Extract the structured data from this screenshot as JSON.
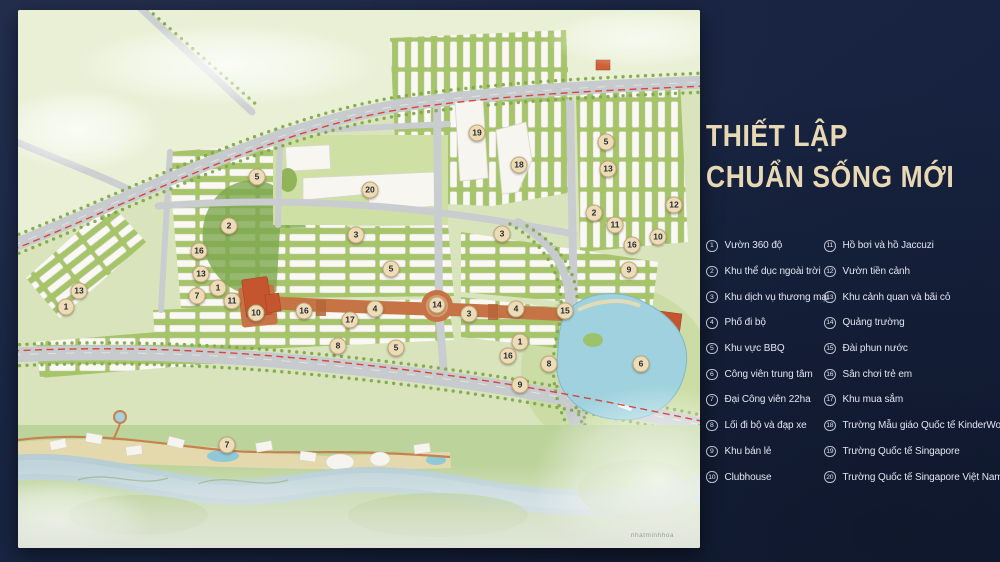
{
  "panel": {
    "title_line1": "THIẾT LẬP",
    "title_line2": "CHUẨN SỐNG MỚI"
  },
  "legend": {
    "items": [
      {
        "num": "1",
        "label": "Vườn 360 độ"
      },
      {
        "num": "2",
        "label": "Khu thể dục ngoài trời"
      },
      {
        "num": "3",
        "label": "Khu dịch vụ thương mại"
      },
      {
        "num": "4",
        "label": "Phố đi bộ"
      },
      {
        "num": "5",
        "label": "Khu vực BBQ"
      },
      {
        "num": "6",
        "label": "Công viên trung tâm"
      },
      {
        "num": "7",
        "label": "Đại Công viên 22ha"
      },
      {
        "num": "8",
        "label": "Lối đi bộ và đạp xe"
      },
      {
        "num": "9",
        "label": "Khu bán lẻ"
      },
      {
        "num": "10",
        "label": "Clubhouse"
      },
      {
        "num": "11",
        "label": "Hồ bơi và hồ Jaccuzi"
      },
      {
        "num": "12",
        "label": "Vườn tiền cảnh"
      },
      {
        "num": "13",
        "label": "Khu cảnh quan và bãi cỏ"
      },
      {
        "num": "14",
        "label": "Quảng trường"
      },
      {
        "num": "15",
        "label": "Đài phun nước"
      },
      {
        "num": "16",
        "label": "Sân chơi trẻ em"
      },
      {
        "num": "17",
        "label": "Khu mua sắm"
      },
      {
        "num": "18",
        "label": "Trường Mẫu giáo Quốc tế KinderWorld"
      },
      {
        "num": "19",
        "label": "Trường Quốc tế Singapore"
      },
      {
        "num": "20",
        "label": "Trường Quốc tế Singapore Việt Nam"
      }
    ]
  },
  "map": {
    "watermark": "nhatminhhoa",
    "markers": [
      {
        "n": "13",
        "x": 61,
        "y": 281
      },
      {
        "n": "1",
        "x": 48,
        "y": 297
      },
      {
        "n": "5",
        "x": 239,
        "y": 167
      },
      {
        "n": "2",
        "x": 211,
        "y": 216
      },
      {
        "n": "16",
        "x": 181,
        "y": 241
      },
      {
        "n": "13",
        "x": 183,
        "y": 264
      },
      {
        "n": "1",
        "x": 200,
        "y": 278
      },
      {
        "n": "7",
        "x": 179,
        "y": 286
      },
      {
        "n": "11",
        "x": 214,
        "y": 291
      },
      {
        "n": "10",
        "x": 238,
        "y": 303
      },
      {
        "n": "20",
        "x": 352,
        "y": 180
      },
      {
        "n": "19",
        "x": 459,
        "y": 123
      },
      {
        "n": "18",
        "x": 501,
        "y": 155
      },
      {
        "n": "3",
        "x": 338,
        "y": 225
      },
      {
        "n": "3",
        "x": 484,
        "y": 224
      },
      {
        "n": "5",
        "x": 373,
        "y": 259
      },
      {
        "n": "16",
        "x": 286,
        "y": 301
      },
      {
        "n": "17",
        "x": 332,
        "y": 310
      },
      {
        "n": "4",
        "x": 357,
        "y": 299
      },
      {
        "n": "8",
        "x": 320,
        "y": 336
      },
      {
        "n": "5",
        "x": 378,
        "y": 338
      },
      {
        "n": "14",
        "x": 419,
        "y": 295
      },
      {
        "n": "5",
        "x": 588,
        "y": 132
      },
      {
        "n": "13",
        "x": 590,
        "y": 159
      },
      {
        "n": "2",
        "x": 576,
        "y": 203
      },
      {
        "n": "11",
        "x": 597,
        "y": 215
      },
      {
        "n": "12",
        "x": 656,
        "y": 195
      },
      {
        "n": "10",
        "x": 640,
        "y": 227
      },
      {
        "n": "16",
        "x": 614,
        "y": 235
      },
      {
        "n": "9",
        "x": 611,
        "y": 260
      },
      {
        "n": "3",
        "x": 451,
        "y": 304
      },
      {
        "n": "4",
        "x": 498,
        "y": 299
      },
      {
        "n": "15",
        "x": 547,
        "y": 301
      },
      {
        "n": "1",
        "x": 502,
        "y": 332
      },
      {
        "n": "16",
        "x": 490,
        "y": 346
      },
      {
        "n": "8",
        "x": 531,
        "y": 354
      },
      {
        "n": "9",
        "x": 502,
        "y": 375
      },
      {
        "n": "6",
        "x": 623,
        "y": 354
      },
      {
        "n": "7",
        "x": 209,
        "y": 435
      }
    ]
  },
  "colors": {
    "background_navy": "#1a2542",
    "title_gold": "#e8d9b4",
    "legend_text": "#e2e6ef",
    "marker_fill": "#eddcb6",
    "boundary_red": "#d8382b",
    "street_orange": "#c67445",
    "lake_blue": "#9fd2de"
  }
}
